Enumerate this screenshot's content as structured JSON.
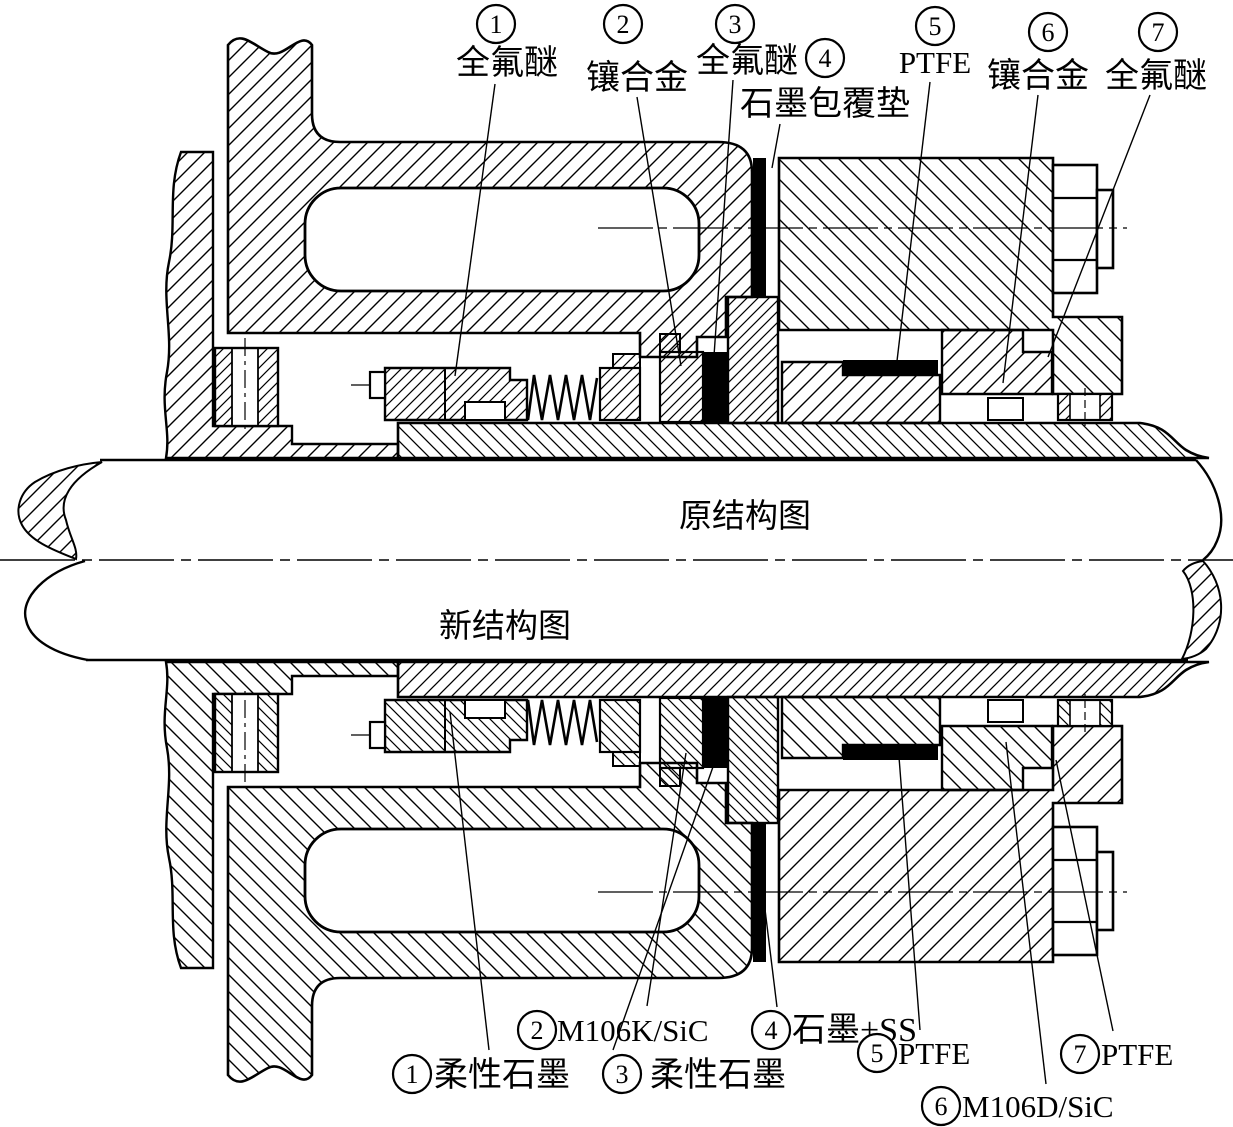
{
  "figure": {
    "kind": "mechanical-seal-cross-section",
    "ink": "#000000",
    "background": "#ffffff"
  },
  "section_labels": [
    {
      "id": "original-structure",
      "text": "原结构图",
      "x": 745,
      "y": 527
    },
    {
      "id": "new-structure",
      "text": "新结构图",
      "x": 505,
      "y": 637
    }
  ],
  "top_callouts": [
    {
      "num": "1",
      "label": "全氟醚",
      "circle": [
        496,
        24
      ],
      "label_pos": [
        507,
        74
      ],
      "anchor": "middle",
      "leader": [
        495,
        84,
        455,
        376
      ]
    },
    {
      "num": "2",
      "label": "镶合金",
      "circle": [
        623,
        24
      ],
      "label_pos": [
        637,
        89
      ],
      "anchor": "middle",
      "leader": [
        637,
        97,
        681,
        366
      ]
    },
    {
      "num": "3",
      "label": "全氟醚",
      "circle": [
        735,
        24
      ],
      "label_pos": [
        747,
        72
      ],
      "anchor": "middle",
      "leader": [
        733,
        80,
        714,
        356
      ]
    },
    {
      "num": "4",
      "label": "石墨包覆垫",
      "circle": [
        825,
        58
      ],
      "label_pos": [
        825,
        115
      ],
      "anchor": "middle",
      "leader": [
        780,
        124,
        772,
        168
      ]
    },
    {
      "num": "5",
      "label": "PTFE",
      "circle": [
        935,
        26
      ],
      "label_pos": [
        935,
        73
      ],
      "anchor": "middle",
      "leader": [
        930,
        82,
        897,
        361
      ]
    },
    {
      "num": "6",
      "label": "镶合金",
      "circle": [
        1048,
        32
      ],
      "label_pos": [
        1038,
        87
      ],
      "anchor": "middle",
      "leader": [
        1038,
        95,
        1003,
        383
      ]
    },
    {
      "num": "7",
      "label": "全氟醚",
      "circle": [
        1158,
        32
      ],
      "label_pos": [
        1156,
        87
      ],
      "anchor": "middle",
      "leader": [
        1150,
        95,
        1048,
        357
      ]
    }
  ],
  "bottom_callouts": [
    {
      "num": "1",
      "label": "柔性石墨",
      "circle": [
        412,
        1074
      ],
      "label_pos": [
        434,
        1086
      ],
      "anchor": "start",
      "leader": [
        450,
        712,
        489,
        1050
      ]
    },
    {
      "num": "2",
      "label": "M106K/SiC",
      "circle": [
        537,
        1030
      ],
      "label_pos": [
        557,
        1041
      ],
      "anchor": "start",
      "leader": [
        686,
        753,
        647,
        1006
      ]
    },
    {
      "num": "3",
      "label": "柔性石墨",
      "circle": [
        622,
        1074
      ],
      "label_pos": [
        650,
        1086
      ],
      "anchor": "start",
      "leader": [
        714,
        764,
        613,
        1050
      ]
    },
    {
      "num": "4",
      "label": "石墨+SS",
      "circle": [
        771,
        1030
      ],
      "label_pos": [
        792,
        1041
      ],
      "anchor": "start",
      "leader": [
        762,
        885,
        777,
        1007
      ]
    },
    {
      "num": "5",
      "label": "PTFE",
      "circle": [
        877,
        1053
      ],
      "label_pos": [
        898,
        1064
      ],
      "anchor": "start",
      "leader": [
        899,
        757,
        920,
        1030
      ]
    },
    {
      "num": "6",
      "label": "M106D/SiC",
      "circle": [
        941,
        1106
      ],
      "label_pos": [
        962,
        1117
      ],
      "anchor": "start",
      "leader": [
        1006,
        742,
        1046,
        1084
      ]
    },
    {
      "num": "7",
      "label": "PTFE",
      "circle": [
        1080,
        1054
      ],
      "label_pos": [
        1101,
        1065
      ],
      "anchor": "start",
      "leader": [
        1056,
        760,
        1113,
        1031
      ]
    }
  ]
}
